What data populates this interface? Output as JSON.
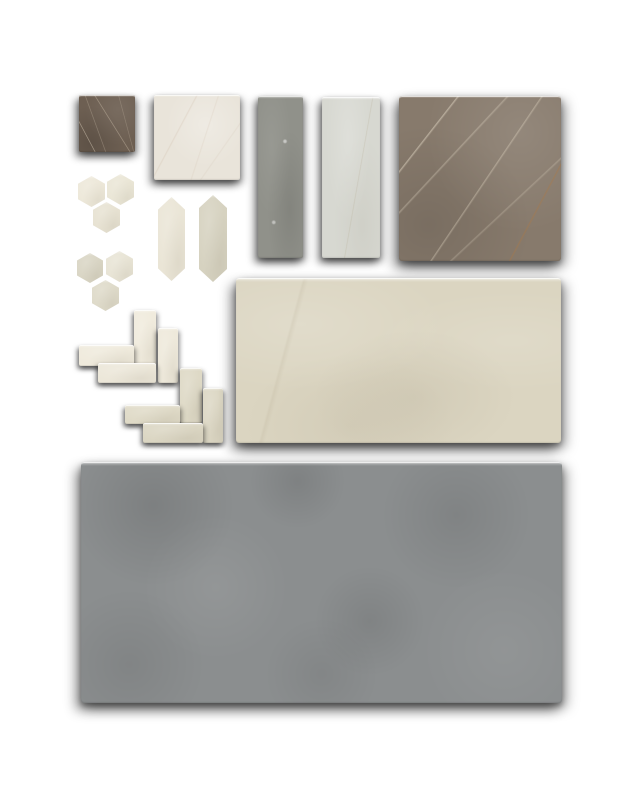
{
  "canvas": {
    "width": 640,
    "height": 800,
    "background": "#ffffff"
  },
  "palette": {
    "dark_brown_marble": "#6d5f52",
    "cream_marble": "#e9e4da",
    "gray_stone": "#90918a",
    "light_gray_stone": "#d7d8d1",
    "taupe_marble": "#877a6c",
    "cream_mosaic": "#ece7d8",
    "greige_mosaic": "#d9d5c4",
    "cream_limestone": "#dbd5c1",
    "gray_concrete": "#8b8e8f"
  },
  "board": {
    "tiles": [
      {
        "name": "sample-square-dark-marble",
        "shape": "rect",
        "texture": "marble-dark",
        "x": 79,
        "y": 95,
        "w": 56,
        "h": 57,
        "base": "#6d5f52"
      },
      {
        "name": "sample-square-cream-marble",
        "shape": "rect",
        "texture": "marble-cream",
        "x": 154,
        "y": 95,
        "w": 86,
        "h": 85,
        "base": "#e9e4da"
      },
      {
        "name": "sample-plank-gray",
        "shape": "rect",
        "texture": "stone-gray",
        "x": 258,
        "y": 96,
        "w": 45,
        "h": 162,
        "base": "#90918a"
      },
      {
        "name": "sample-plank-light-gray",
        "shape": "rect",
        "texture": "stone-light",
        "x": 322,
        "y": 97,
        "w": 58,
        "h": 161,
        "base": "#d7d8d1"
      },
      {
        "name": "sample-square-taupe-marble",
        "shape": "rect",
        "texture": "marble-taupe",
        "x": 399,
        "y": 96,
        "w": 162,
        "h": 165,
        "base": "#877a6c"
      },
      {
        "name": "hex-mosaic-a-chip-left",
        "shape": "hex",
        "texture": "plain",
        "x": 78,
        "y": 176,
        "w": 27,
        "h": 31,
        "base": "#ede8d9"
      },
      {
        "name": "hex-mosaic-a-chip-right",
        "shape": "hex",
        "texture": "plain",
        "x": 107,
        "y": 174,
        "w": 27,
        "h": 31,
        "base": "#eae6d6"
      },
      {
        "name": "hex-mosaic-a-chip-bottom",
        "shape": "hex",
        "texture": "plain",
        "x": 93,
        "y": 202,
        "w": 27,
        "h": 31,
        "base": "#e7e2d2"
      },
      {
        "name": "sample-picket-cream",
        "shape": "picket",
        "texture": "plain",
        "x": 158,
        "y": 197,
        "w": 27,
        "h": 84,
        "base": "#eae5d6"
      },
      {
        "name": "sample-picket-greige",
        "shape": "picket",
        "texture": "plain",
        "x": 199,
        "y": 195,
        "w": 28,
        "h": 87,
        "base": "#d6d2c0"
      },
      {
        "name": "hex-mosaic-b-chip-left",
        "shape": "hex",
        "texture": "plain",
        "x": 77,
        "y": 253,
        "w": 26,
        "h": 30,
        "base": "#d9d5c4"
      },
      {
        "name": "hex-mosaic-b-chip-right",
        "shape": "hex",
        "texture": "plain",
        "x": 106,
        "y": 251,
        "w": 27,
        "h": 31,
        "base": "#e8e4d5"
      },
      {
        "name": "hex-mosaic-b-chip-bottom",
        "shape": "hex",
        "texture": "plain",
        "x": 92,
        "y": 280,
        "w": 27,
        "h": 31,
        "base": "#dedac9"
      },
      {
        "name": "herringbone-a-brick-vertical-1",
        "shape": "rect",
        "texture": "plain",
        "x": 134,
        "y": 310,
        "w": 22,
        "h": 55,
        "base": "#f0ebdd"
      },
      {
        "name": "herringbone-a-brick-vertical-2",
        "shape": "rect",
        "texture": "plain",
        "x": 158,
        "y": 328,
        "w": 20,
        "h": 55,
        "base": "#eee9db"
      },
      {
        "name": "herringbone-a-brick-horizontal-1",
        "shape": "rect",
        "texture": "plain",
        "x": 79,
        "y": 345,
        "w": 55,
        "h": 21,
        "base": "#efeadc"
      },
      {
        "name": "herringbone-a-brick-horizontal-2",
        "shape": "rect",
        "texture": "plain",
        "x": 98,
        "y": 363,
        "w": 58,
        "h": 20,
        "base": "#ece7d9"
      },
      {
        "name": "herringbone-b-brick-vertical-1",
        "shape": "rect",
        "texture": "plain",
        "x": 180,
        "y": 368,
        "w": 22,
        "h": 55,
        "base": "#ded9c6"
      },
      {
        "name": "herringbone-b-brick-vertical-2",
        "shape": "rect",
        "texture": "plain",
        "x": 203,
        "y": 388,
        "w": 20,
        "h": 55,
        "base": "#dcd7c4"
      },
      {
        "name": "herringbone-b-brick-horizontal-1",
        "shape": "rect",
        "texture": "plain",
        "x": 125,
        "y": 405,
        "w": 55,
        "h": 19,
        "base": "#dfdac7"
      },
      {
        "name": "herringbone-b-brick-horizontal-2",
        "shape": "rect",
        "texture": "plain",
        "x": 143,
        "y": 423,
        "w": 60,
        "h": 20,
        "base": "#dbd6c3"
      },
      {
        "name": "sample-slab-cream-limestone",
        "shape": "rect",
        "texture": "limestone",
        "x": 236,
        "y": 278,
        "w": 325,
        "h": 165,
        "base": "#dbd5c1"
      },
      {
        "name": "sample-slab-gray-concrete",
        "shape": "rect",
        "texture": "concrete",
        "x": 81,
        "y": 462,
        "w": 481,
        "h": 241,
        "base": "#8b8e8f"
      }
    ]
  }
}
